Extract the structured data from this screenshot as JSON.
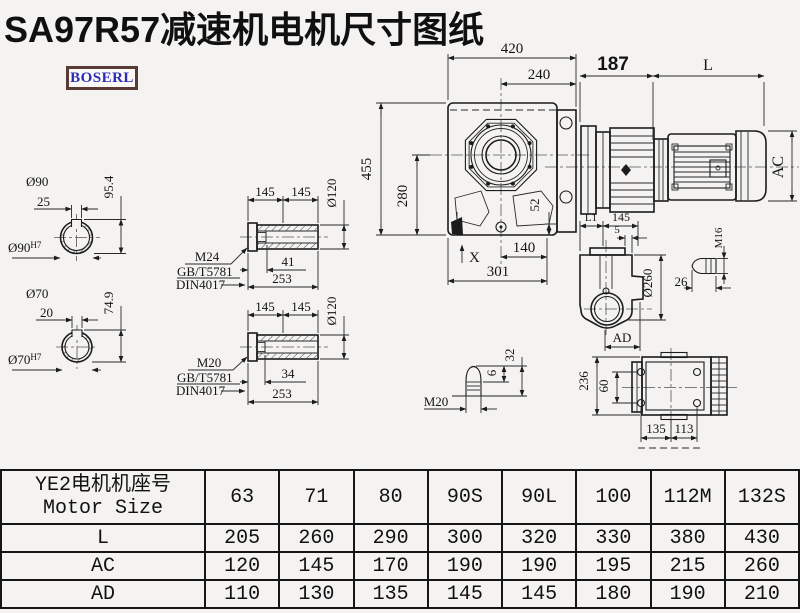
{
  "title": "SA97R57减速机电机尺寸图纸",
  "logo": "BOSERL",
  "colors": {
    "title": "#101010",
    "logo_text": "#2b2bb5",
    "logo_border": "#5a3a34",
    "line": "#1c1c1c"
  },
  "main_view": {
    "top_width": "420",
    "inner_width": "240",
    "adapter_len": "187",
    "motor_len": "L",
    "height": "455",
    "center_height": "280",
    "flange": "52",
    "foot_inner": "140",
    "foot_len": "301",
    "x_mark": "X",
    "motor_dia": "AC"
  },
  "output_shaft_90": {
    "dia": "Ø90",
    "key_width": "25",
    "key_height": "95.4",
    "bore": "Ø90",
    "bore_tol": "H7"
  },
  "output_shaft_70": {
    "dia": "Ø70",
    "key_width": "20",
    "key_height": "74.9",
    "bore": "Ø70",
    "bore_tol": "H7"
  },
  "hollow_shaft_1": {
    "half_1": "145",
    "half_2": "145",
    "dia": "Ø120",
    "thread_depth": "41",
    "length": "253",
    "thread": "M24",
    "std_1": "GB/T5781",
    "std_2": "DIN4017"
  },
  "hollow_shaft_2": {
    "half_1": "145",
    "half_2": "145",
    "dia": "Ø120",
    "thread_depth": "34",
    "length": "253",
    "thread": "M20",
    "std_1": "GB/T5781",
    "std_2": "DIN4017"
  },
  "retaining_bolt": {
    "thread": "M20",
    "tip_len": "6",
    "length": "32"
  },
  "side_view": {
    "l1": "L1",
    "width_145": "145",
    "offset_5": "5",
    "flange_dia": "Ø260",
    "ad": "AD",
    "bolt_thread": "M16",
    "bolt_len": "26"
  },
  "rear_view": {
    "height_236": "236",
    "hole_span_60": "60",
    "foot_135": "135",
    "foot_113": "113"
  },
  "table": {
    "header_line1": "YE2电机机座号",
    "header_line2": "Motor Size",
    "sizes": [
      "63",
      "71",
      "80",
      "90S",
      "90L",
      "100",
      "112M",
      "132S"
    ],
    "rows": [
      {
        "label": "L",
        "values": [
          "205",
          "260",
          "290",
          "300",
          "320",
          "330",
          "380",
          "430"
        ]
      },
      {
        "label": "AC",
        "values": [
          "120",
          "145",
          "170",
          "190",
          "190",
          "195",
          "215",
          "260"
        ]
      },
      {
        "label": "AD",
        "values": [
          "110",
          "130",
          "135",
          "145",
          "145",
          "180",
          "190",
          "210"
        ]
      }
    ]
  }
}
